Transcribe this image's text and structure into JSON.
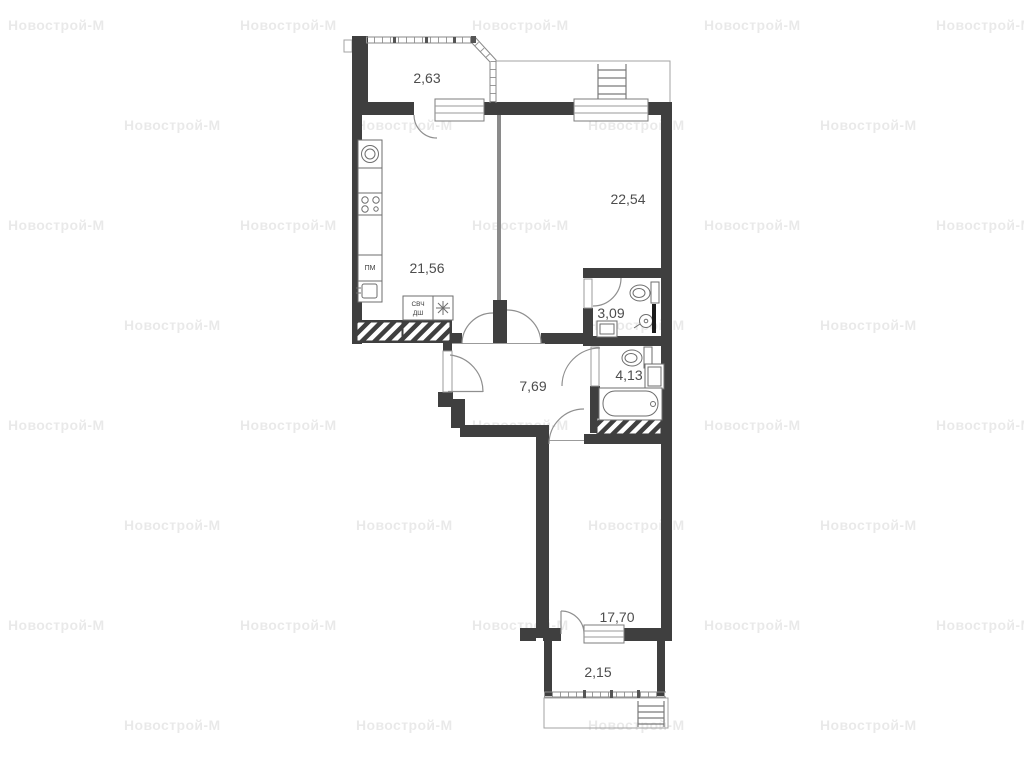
{
  "watermark": {
    "text": "Новострой-М"
  },
  "plan": {
    "title": "2-room apartment floor plan",
    "rooms": {
      "balcony_top": {
        "label": "2,63"
      },
      "living": {
        "label": "22,54"
      },
      "kitchen": {
        "label": "21,56"
      },
      "wc": {
        "label": "3,09"
      },
      "hall": {
        "label": "7,69"
      },
      "bath": {
        "label": "4,13"
      },
      "bedroom": {
        "label": "17,70"
      },
      "balcony_bottom": {
        "label": "2,15"
      }
    },
    "appliances": {
      "dishwasher": "ПМ",
      "microwave": "СВЧ",
      "oven": "ДШ"
    },
    "icons": {
      "fridge": "snowflake-icon",
      "stove": "stove-burners-icon",
      "washing_machine": "washing-machine-icon",
      "sink": "sink-icon",
      "toilet": "toilet-icon",
      "shower": "shower-icon",
      "bathtub": "bathtub-icon",
      "ladder": "ladder-icon"
    },
    "colors": {
      "wall": "#3f3f3f",
      "partition": "#8a8a8a",
      "line": "#9a9a9a",
      "label_text": "#4d4d4d",
      "watermark": "rgba(0,0,0,0.085)",
      "background": "#ffffff"
    }
  }
}
